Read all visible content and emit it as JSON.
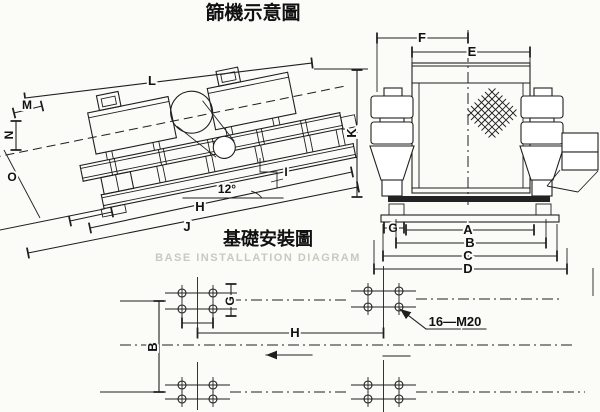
{
  "colors": {
    "ink": "#1f1f1f",
    "paper": "#fbfbf8",
    "watermark": "#c9c9c1"
  },
  "titles": {
    "main": "篩機示意圖",
    "installation": "基礎安裝圖",
    "installation_en": "BASE INSTALLATION DIAGRAM"
  },
  "side_view": {
    "angle": "12°",
    "dims": {
      "L": "L",
      "M": "M",
      "N": "N",
      "O": "O",
      "K": "K",
      "H": "H",
      "I": "I",
      "J": "J"
    }
  },
  "front_view": {
    "dims": {
      "F": "F",
      "E": "E",
      "G": "G",
      "A": "A",
      "B": "B",
      "C": "C",
      "D": "D"
    }
  },
  "plan_view": {
    "dims": {
      "B": "B",
      "G": "G",
      "H": "H"
    },
    "bolt_spec": "16—M20"
  }
}
